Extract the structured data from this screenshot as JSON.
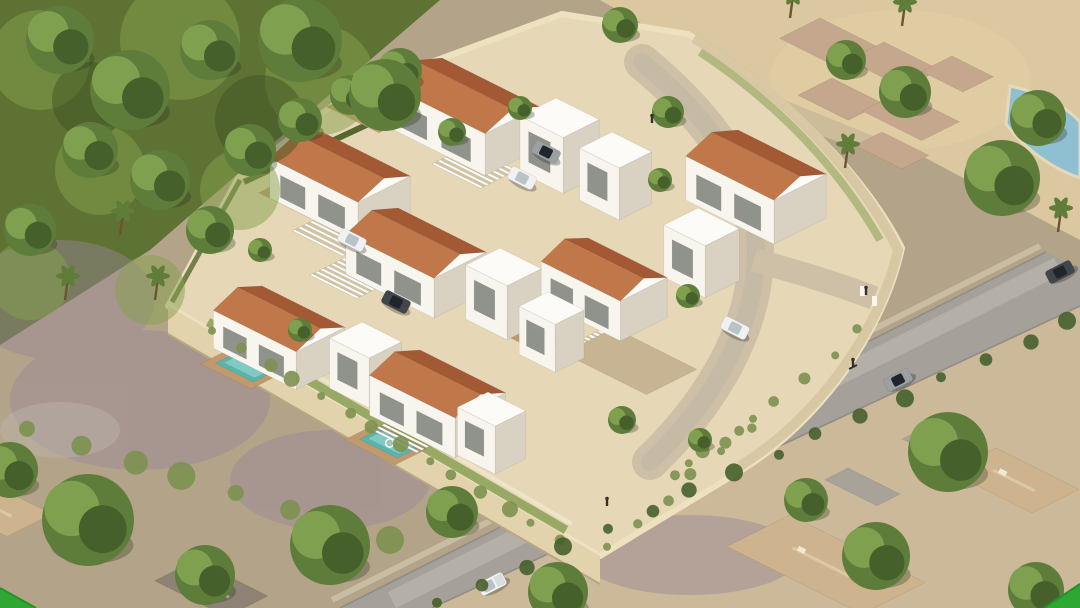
{
  "meta": {
    "type": "architectural-aerial-render",
    "subject": "Gated development of modern white villas with terracotta gable roofs, private pools and a curved internal drive",
    "view": "isometric aerial 3D visualization",
    "visible_text": "(none)"
  },
  "palette": {
    "green-hill": "#5e7234",
    "leaf-light": "#85a04c",
    "leaf-dark": "#3c4f22",
    "scrub": "#b3a489",
    "scrub-purple": "#9a8798",
    "scrub-light": "#cbb999",
    "sand": "#dbc7a0",
    "road": "#a5a099",
    "road-light": "#bfbab1",
    "wall": "#eee1c0",
    "wall-face": "#e3d3ad",
    "wall-stone": "#d7c6a2",
    "terrace": "#e6d8b6",
    "path-c": "#cdc0a6",
    "parking": "#c7b493",
    "villa-white": "#f8f5ee",
    "villa-shade": "#d9d2c3",
    "villa-top": "#fcfbf8",
    "roof-front": "#c0774a",
    "roof-back": "#a25934",
    "pool": "#5ab3ac",
    "pool-light": "#8fd6cd",
    "neighbor-pool": "#8fc0d2",
    "deck": "#c09a6e",
    "hedge": "#55682f",
    "vine": "#7d9150",
    "finca-roof": "#c4a78c",
    "finca-edge": "#a08468",
    "suburb-roof": "#cdb48f",
    "suburb-edge": "#b0977a",
    "car-dark": "#41454c",
    "car-white": "#eff1f2",
    "car-silver": "#9aa0a4",
    "watermark-green": "#2fa733",
    "watermark-green-dark": "#23922b",
    "tree-dark": "#46602c",
    "tree-mid": "#5f7d3a",
    "tree-light": "#7fa04f",
    "trunk": "#6b5334",
    "person": "#35302a",
    "window": "#82867f"
  },
  "scene": {
    "compound": {
      "terracotta_roof_villas": 7,
      "white_flat_roof_volumes": 7,
      "swimming_pools": 5,
      "wood_pool_decks": 5,
      "pergolas_carports": 5,
      "internal_road": "curved drive from north entrance to east gate",
      "parked_cars_inside": 4,
      "perimeter": "cream rendered wall with stone-textured east face and trailing vines"
    },
    "surroundings": {
      "north_west": "dense green woodland hillside with palm trees",
      "north_east": "old flat stone-roofed finca on a sandy lot with round trees and a neighbouring blue pool",
      "east": "asphalt road with passing car, cyclist and boundary wall",
      "south": "asphalt road with white pickup truck, scrubland with purple patches and suburban houses with tan hipped roofs among large trees"
    },
    "vehicles": {
      "total": 8,
      "types": [
        "white suv (driving)",
        "white cars",
        "dark sedans",
        "silver car",
        "white pickup truck"
      ]
    },
    "people": {
      "pedestrians": 3,
      "cyclists": 1,
      "swimmers": 3
    },
    "corner_accents": {
      "shape": "green triangles",
      "positions": [
        "bottom-left",
        "bottom-right"
      ],
      "color_key": "watermark-green"
    }
  }
}
